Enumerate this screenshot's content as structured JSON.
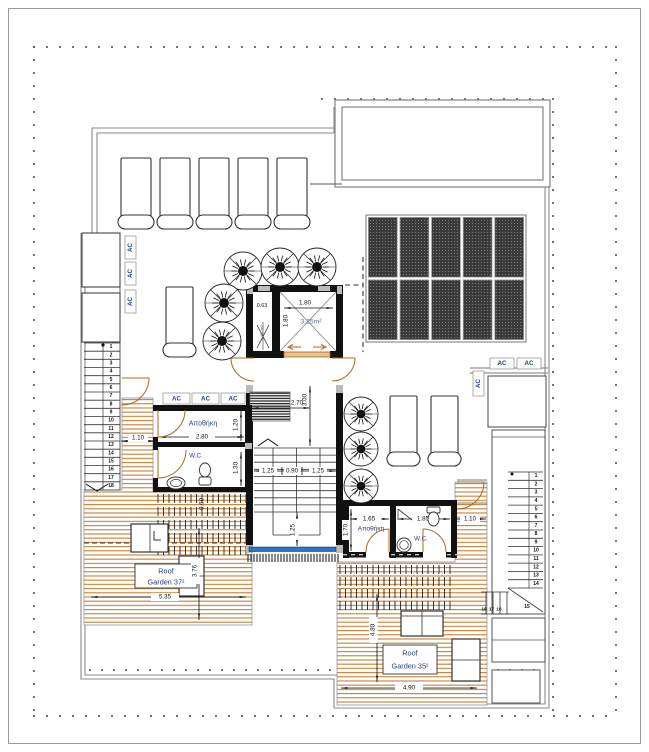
{
  "drawing": {
    "labels": {
      "ac": "AC",
      "storage_left": "Αποθήκη",
      "storage_right": "Αποθήκη",
      "wc_left": "W.C.",
      "wc_right": "W.C.",
      "elevator_area": "3.25m²",
      "shaft_area": "1.25 m²",
      "roof_garden_left_line1": "Roof",
      "roof_garden_left_line2": "Garden 37²",
      "roof_garden_right_line1": "Roof",
      "roof_garden_right_line2": "Garden 35²"
    },
    "dimensions": {
      "elevator_width": "1.80",
      "elevator_depth": "1.80",
      "shaft_width": "0.63",
      "lobby_width": "2.70",
      "stairwell_length": "3.00",
      "stair_flight_left": "1.25",
      "stair_gap": "0.90",
      "stair_flight_right": "1.25",
      "stair_landing": "1.25",
      "left_passage": "1.10",
      "storage_left_width": "2.80",
      "storage_left_depth": "1.20",
      "wc_left_depth": "1.30",
      "pergola_depth": "0.60",
      "left_garden_depth": "3.76",
      "left_garden_width": "5.35",
      "storage_right_width": "1.65",
      "storage_right_depth": "1.70",
      "wc_right_width": "1.85",
      "right_passage": "1.10",
      "right_garden_depth": "4.80",
      "right_garden_width": "4.90"
    },
    "stairs": {
      "left_numbers": [
        "1",
        "2",
        "3",
        "4",
        "5",
        "6",
        "7",
        "8",
        "9",
        "10",
        "11",
        "12",
        "13",
        "14",
        "15",
        "16",
        "17",
        "18"
      ],
      "right_numbers": [
        "1",
        "2",
        "3",
        "4",
        "5",
        "6",
        "7",
        "8",
        "9",
        "10",
        "11",
        "12",
        "13",
        "14"
      ],
      "right_winder_number": "15",
      "right_bottom_numbers": [
        "16",
        "17",
        "18"
      ]
    },
    "counts": {
      "top_sun_loungers": 5,
      "right_sun_loungers": 2,
      "terrace_sun_loungers": 1,
      "solar_panel_columns": 5,
      "solar_panel_rows": 2,
      "plants": 8
    },
    "colors": {
      "deck_stripe": "#c9853f",
      "door": "#b4641e",
      "wall": "#111111",
      "label_navy": "#27417d",
      "glass_blue": "#2e74c8",
      "solar_panel": "#3a3a3a",
      "outline_gray": "#8a8a8a",
      "area_text": "#5a6b8c"
    }
  }
}
